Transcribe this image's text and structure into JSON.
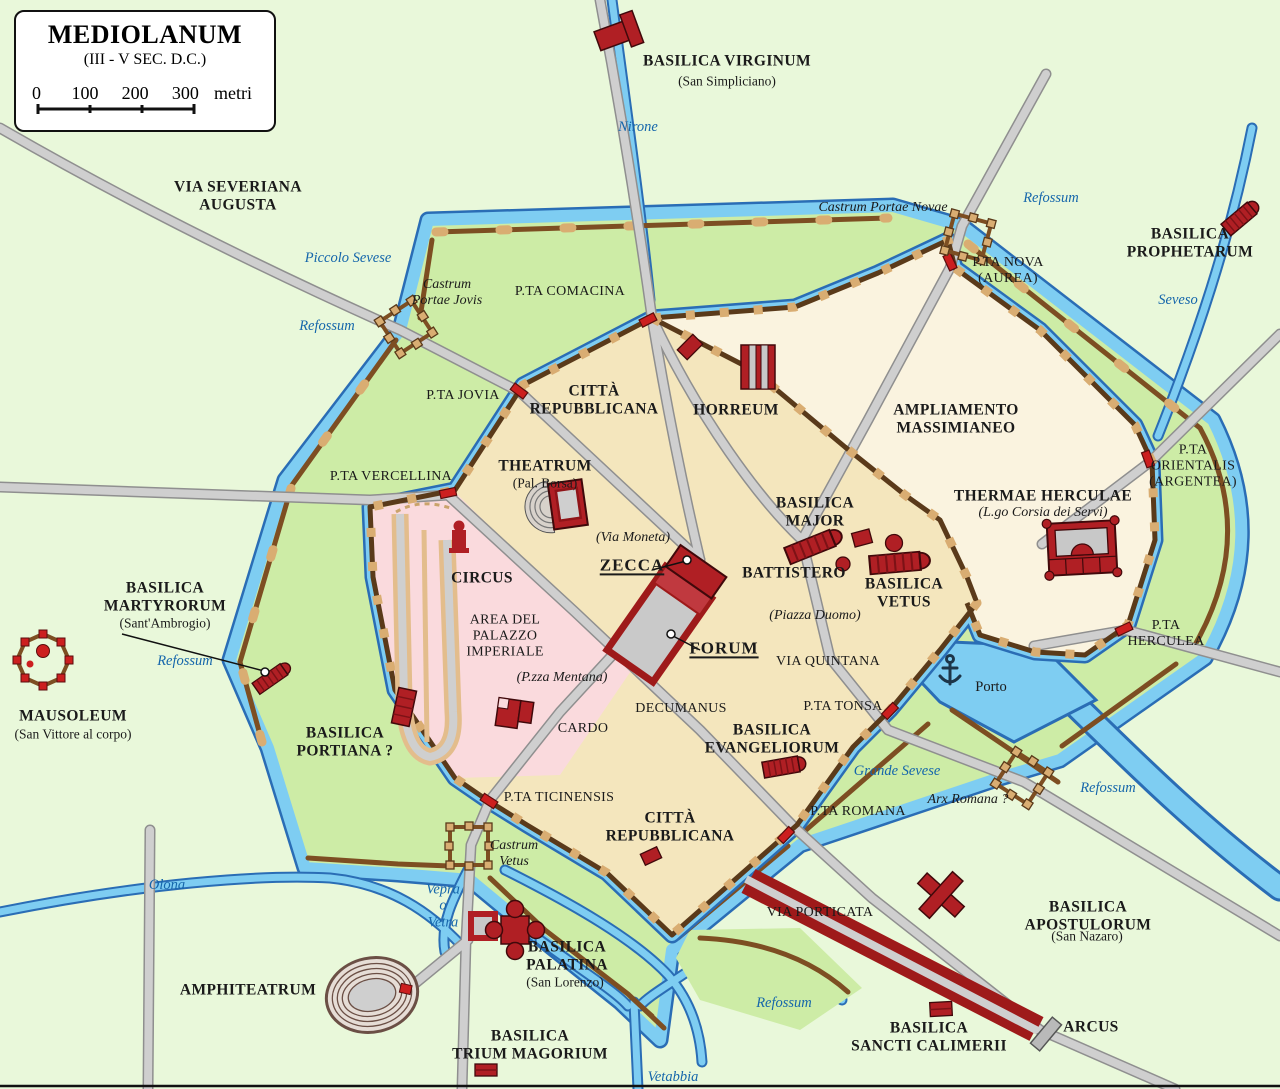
{
  "legend": {
    "title": "MEDIOLANUM",
    "subtitle": "(III - V SEC. D.C.)",
    "scale_ticks": [
      "0",
      "100",
      "200",
      "300"
    ],
    "scale_unit": "metri"
  },
  "palette": {
    "background_green": "#e9f8da",
    "ring_green": "#cdeca6",
    "city_tan": "#f4e6bd",
    "ampliamento_cream": "#faf3df",
    "palace_pink": "#fadadd",
    "water_fill": "#7ecdf2",
    "water_edge": "#2a6db5",
    "wall_brown": "#7d4e22",
    "wall_tan": "#d9ad72",
    "building_red": "#b01f24",
    "gate_red": "#cc1f1f",
    "road_gray": "#cfcfcf",
    "water_label_blue": "#1566ab",
    "label_black": "#1a1a1a"
  },
  "map": {
    "labels": [
      {
        "id": "basilica-virginum",
        "text": "BASILICA VIRGINUM",
        "x": 727,
        "y": 61,
        "cls": "major"
      },
      {
        "id": "san-simpliciano",
        "text": "(San Simpliciano)",
        "x": 727,
        "y": 81,
        "cls": "sub"
      },
      {
        "id": "nirone",
        "text": "Nirone",
        "x": 638,
        "y": 127,
        "cls": "water"
      },
      {
        "id": "via-severiana-augusta",
        "text": "VIA SEVERIANA\nAUGUSTA",
        "x": 238,
        "y": 196,
        "cls": "major"
      },
      {
        "id": "refossum-ne",
        "text": "Refossum",
        "x": 1051,
        "y": 198,
        "cls": "water"
      },
      {
        "id": "castrum-portae-novae",
        "text": "Castrum Portae Novae",
        "x": 883,
        "y": 208,
        "cls": "italic"
      },
      {
        "id": "basilica-prophetarum",
        "text": "BASILICA\nPROPHETARUM",
        "x": 1190,
        "y": 243,
        "cls": "major"
      },
      {
        "id": "pta-nova",
        "text": "P.TA NOVA\n(AUREA)",
        "x": 1008,
        "y": 271,
        "cls": "minor"
      },
      {
        "id": "piccolo-sevese",
        "text": "Piccolo Sevese",
        "x": 348,
        "y": 258,
        "cls": "water"
      },
      {
        "id": "pta-comacina",
        "text": "P.TA COMACINA",
        "x": 570,
        "y": 292,
        "cls": "minor"
      },
      {
        "id": "castrum-portae-jovis",
        "text": "Castrum\nPortae Jovis",
        "x": 447,
        "y": 293,
        "cls": "italic"
      },
      {
        "id": "seveso",
        "text": "Seveso",
        "x": 1178,
        "y": 300,
        "cls": "water"
      },
      {
        "id": "refossum-nw",
        "text": "Refossum",
        "x": 327,
        "y": 326,
        "cls": "water"
      },
      {
        "id": "pta-jovia",
        "text": "P.TA JOVIA",
        "x": 463,
        "y": 396,
        "cls": "minor"
      },
      {
        "id": "citta-repubblicana-nord",
        "text": "CITTÀ\nREPUBBLICANA",
        "x": 594,
        "y": 400,
        "cls": "major"
      },
      {
        "id": "horreum",
        "text": "HORREUM",
        "x": 736,
        "y": 410,
        "cls": "major"
      },
      {
        "id": "ampliamento-massimianeo",
        "text": "AMPLIAMENTO\nMASSIMIANEO",
        "x": 956,
        "y": 419,
        "cls": "major"
      },
      {
        "id": "theatrum",
        "text": "THEATRUM",
        "x": 545,
        "y": 466,
        "cls": "major"
      },
      {
        "id": "pal-borsa",
        "text": "(Pal. Borsa)",
        "x": 545,
        "y": 483,
        "cls": "sub"
      },
      {
        "id": "pta-vercellina",
        "text": "P.TA VERCELLINA",
        "x": 391,
        "y": 477,
        "cls": "minor"
      },
      {
        "id": "pta-orientalis",
        "text": "P.TA\nORIENTALIS\n(ARGENTEA)",
        "x": 1193,
        "y": 466,
        "cls": "minor"
      },
      {
        "id": "basilica-major",
        "text": "BASILICA\nMAJOR",
        "x": 815,
        "y": 512,
        "cls": "major"
      },
      {
        "id": "thermae-herculae",
        "text": "THERMAE HERCULAE",
        "x": 1043,
        "y": 496,
        "cls": "major"
      },
      {
        "id": "lgo-corsia-dei-servi",
        "text": "(L.go Corsia dei Servi)",
        "x": 1043,
        "y": 513,
        "cls": "italic"
      },
      {
        "id": "via-moneta",
        "text": "(Via Moneta)",
        "x": 633,
        "y": 538,
        "cls": "italic"
      },
      {
        "id": "zecca",
        "text": "ZECCA",
        "x": 632,
        "y": 565,
        "cls": "ref"
      },
      {
        "id": "battistero",
        "text": "BATTISTERO",
        "x": 794,
        "y": 573,
        "cls": "major"
      },
      {
        "id": "basilica-vetus",
        "text": "BASILICA\nVETUS",
        "x": 904,
        "y": 593,
        "cls": "major"
      },
      {
        "id": "circus",
        "text": "CIRCUS",
        "x": 482,
        "y": 578,
        "cls": "major"
      },
      {
        "id": "basilica-martyrorum",
        "text": "BASILICA\nMARTYRORUM",
        "x": 165,
        "y": 597,
        "cls": "major"
      },
      {
        "id": "sant-ambrogio",
        "text": "(Sant'Ambrogio)",
        "x": 165,
        "y": 623,
        "cls": "sub"
      },
      {
        "id": "piazza-duomo",
        "text": "(Piazza Duomo)",
        "x": 815,
        "y": 616,
        "cls": "italic"
      },
      {
        "id": "area-del-palazzo-imperiale",
        "text": "AREA DEL\nPALAZZO\nIMPERIALE",
        "x": 505,
        "y": 636,
        "cls": "minor"
      },
      {
        "id": "refossum-ovest",
        "text": "Refossum",
        "x": 185,
        "y": 661,
        "cls": "water"
      },
      {
        "id": "forum",
        "text": "FORUM",
        "x": 724,
        "y": 648,
        "cls": "ref"
      },
      {
        "id": "via-quintana",
        "text": "VIA QUINTANA",
        "x": 828,
        "y": 662,
        "cls": "minor"
      },
      {
        "id": "pta-herculea",
        "text": "P.TA\nHERCULEA",
        "x": 1166,
        "y": 634,
        "cls": "minor"
      },
      {
        "id": "pzza-mentana",
        "text": "(P.zza Mentana)",
        "x": 562,
        "y": 678,
        "cls": "italic"
      },
      {
        "id": "mausoleum",
        "text": "MAUSOLEUM",
        "x": 73,
        "y": 716,
        "cls": "major"
      },
      {
        "id": "san-vittore-al-corpo",
        "text": "(San Vittore al corpo)",
        "x": 73,
        "y": 734,
        "cls": "sub"
      },
      {
        "id": "decumanus",
        "text": "DECUMANUS",
        "x": 681,
        "y": 709,
        "cls": "minor"
      },
      {
        "id": "pta-tonsa",
        "text": "P.TA TONSA",
        "x": 843,
        "y": 707,
        "cls": "minor"
      },
      {
        "id": "porto",
        "text": "Porto",
        "x": 991,
        "y": 687,
        "cls": "minor2"
      },
      {
        "id": "cardo",
        "text": "CARDO",
        "x": 583,
        "y": 729,
        "cls": "minor"
      },
      {
        "id": "basilica-evangeliorum",
        "text": "BASILICA\nEVANGELIORUM",
        "x": 772,
        "y": 739,
        "cls": "major"
      },
      {
        "id": "basilica-portiana",
        "text": "BASILICA\nPORTIANA ?",
        "x": 345,
        "y": 742,
        "cls": "major"
      },
      {
        "id": "grande-sevese",
        "text": "Grande Sevese",
        "x": 897,
        "y": 771,
        "cls": "water"
      },
      {
        "id": "refossum-est",
        "text": "Refossum",
        "x": 1108,
        "y": 788,
        "cls": "water"
      },
      {
        "id": "arx-romana",
        "text": "Arx Romana ?",
        "x": 968,
        "y": 800,
        "cls": "italic"
      },
      {
        "id": "pta-ticinensis",
        "text": "P.TA TICINENSIS",
        "x": 559,
        "y": 798,
        "cls": "minor"
      },
      {
        "id": "citta-repubblicana-sud",
        "text": "CITTÀ\nREPUBBLICANA",
        "x": 670,
        "y": 827,
        "cls": "major"
      },
      {
        "id": "pta-romana",
        "text": "P.TA ROMANA",
        "x": 858,
        "y": 812,
        "cls": "minor"
      },
      {
        "id": "castrum-vetus",
        "text": "Castrum\nVetus",
        "x": 514,
        "y": 854,
        "cls": "italic"
      },
      {
        "id": "olona",
        "text": "Olona",
        "x": 167,
        "y": 885,
        "cls": "water"
      },
      {
        "id": "vepra-o-vetra",
        "text": "Vepra\no\nVetra",
        "x": 443,
        "y": 906,
        "cls": "water"
      },
      {
        "id": "via-porticata",
        "text": "VIA PORTICATA",
        "x": 820,
        "y": 913,
        "cls": "minor"
      },
      {
        "id": "basilica-apostulorum",
        "text": "BASILICA APOSTULORUM",
        "x": 1088,
        "y": 916,
        "cls": "major"
      },
      {
        "id": "san-nazaro",
        "text": "(San Nazaro)",
        "x": 1087,
        "y": 936,
        "cls": "sub"
      },
      {
        "id": "basilica-palatina",
        "text": "BASILICA\nPALATINA",
        "x": 567,
        "y": 956,
        "cls": "major"
      },
      {
        "id": "san-lorenzo",
        "text": "(San Lorenzo)",
        "x": 565,
        "y": 982,
        "cls": "sub"
      },
      {
        "id": "amphiteatrum",
        "text": "AMPHITEATRUM",
        "x": 248,
        "y": 990,
        "cls": "major"
      },
      {
        "id": "refossum-sud",
        "text": "Refossum",
        "x": 784,
        "y": 1003,
        "cls": "water"
      },
      {
        "id": "basilica-sancti-calimerii",
        "text": "BASILICA\nSANCTI CALIMERII",
        "x": 929,
        "y": 1037,
        "cls": "major"
      },
      {
        "id": "arcus",
        "text": "ARCUS",
        "x": 1091,
        "y": 1027,
        "cls": "major"
      },
      {
        "id": "basilica-trium-magorium",
        "text": "BASILICA\nTRIUM MAGORIUM",
        "x": 530,
        "y": 1045,
        "cls": "major"
      },
      {
        "id": "vetabbia",
        "text": "Vetabbia",
        "x": 673,
        "y": 1077,
        "cls": "water"
      }
    ]
  }
}
